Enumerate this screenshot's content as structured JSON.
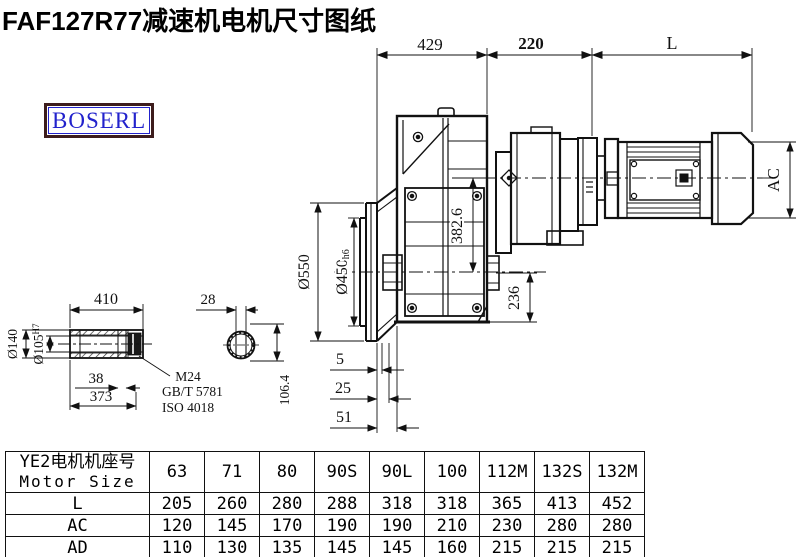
{
  "title": "FAF127R77减速机电机尺寸图纸",
  "logo": "BOSERL",
  "dims": {
    "total_reducer": "429",
    "adapter_len": "220",
    "motor_len": "L",
    "motor_ac": "AC",
    "flange_od": "Ø550",
    "spigot": "Ø450",
    "spigot_tol": "h6",
    "axis_span": "382.6",
    "below_axis": "236",
    "s5": "5",
    "s25": "25",
    "s51": "51"
  },
  "shaft_detail": {
    "length": "410",
    "hub_od": "Ø140",
    "bore": "Ø105",
    "bore_tol": "H7",
    "groove": "38",
    "length2": "373",
    "note1": "M24",
    "note2": "GB/T 5781",
    "note3": "ISO 4018"
  },
  "section_view": {
    "key_width": "28",
    "bore_height": "106.4"
  },
  "table": {
    "header_cn": "YE2电机机座号",
    "header_en": "Motor Size",
    "columns": [
      "63",
      "71",
      "80",
      "90S",
      "90L",
      "100",
      "112M",
      "132S",
      "132M"
    ],
    "rows": [
      {
        "label": "L",
        "values": [
          "205",
          "260",
          "280",
          "288",
          "318",
          "318",
          "365",
          "413",
          "452"
        ]
      },
      {
        "label": "AC",
        "values": [
          "120",
          "145",
          "170",
          "190",
          "190",
          "210",
          "230",
          "280",
          "280"
        ]
      },
      {
        "label": "AD",
        "values": [
          "110",
          "130",
          "135",
          "145",
          "145",
          "160",
          "215",
          "215",
          "215"
        ]
      }
    ]
  }
}
